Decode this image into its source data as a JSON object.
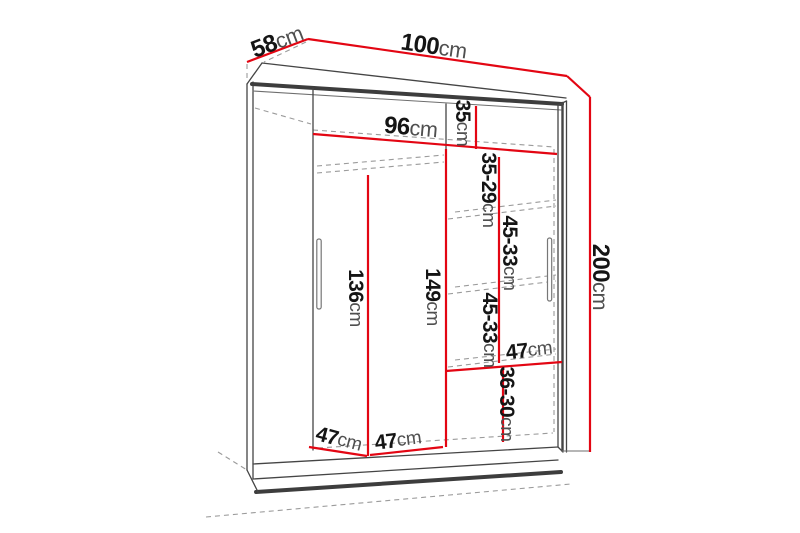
{
  "diagram_title": "Wardrobe dimension diagram",
  "colors": {
    "dimension_line": "#e30613",
    "outline": "#454545",
    "hidden_line": "#9b9b9b",
    "number_text": "#151515",
    "unit_text": "#4f4f4f",
    "background": "#ffffff"
  },
  "dimensions": {
    "width": {
      "num": "100",
      "unit": "cm"
    },
    "depth": {
      "num": "58",
      "unit": "cm"
    },
    "height": {
      "num": "200",
      "unit": "cm"
    },
    "interior_width": {
      "num": "96",
      "unit": "cm"
    },
    "top_compartment": {
      "num": "35",
      "unit": "cm"
    },
    "upper_shelf_gap": {
      "num": "35-29",
      "unit": "cm"
    },
    "middle_shelf_gap_1": {
      "num": "45-33",
      "unit": "cm"
    },
    "middle_shelf_gap_2": {
      "num": "45-33",
      "unit": "cm"
    },
    "bottom_shelf_gap": {
      "num": "36-30",
      "unit": "cm"
    },
    "left_interior_height": {
      "num": "136",
      "unit": "cm"
    },
    "right_interior_height": {
      "num": "149",
      "unit": "cm"
    },
    "shelf_width": {
      "num": "47",
      "unit": "cm"
    },
    "left_section_width": {
      "num": "47",
      "unit": "cm"
    },
    "right_section_width": {
      "num": "47",
      "unit": "cm"
    }
  }
}
